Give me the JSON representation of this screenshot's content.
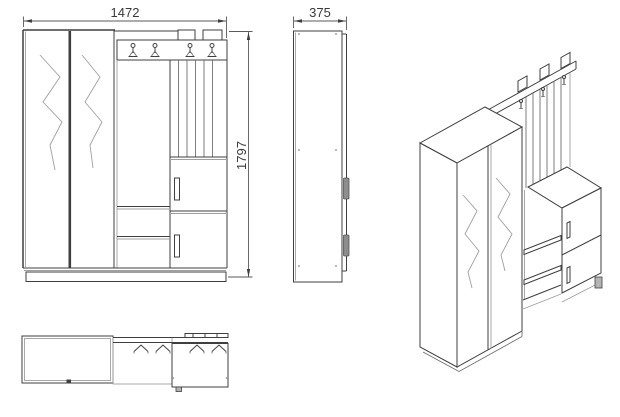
{
  "drawing": {
    "views": {
      "front": {
        "width_dimension": "1472",
        "height_dimension": "1797"
      },
      "side": {
        "depth_dimension": "375"
      },
      "isometric": {},
      "plan": {}
    },
    "colors": {
      "background": "#ffffff",
      "line_dark": "#3f3f3f",
      "line_medium": "#707070",
      "line_light": "#9f9f9f",
      "handle_fill": "#8d8d8d"
    }
  }
}
